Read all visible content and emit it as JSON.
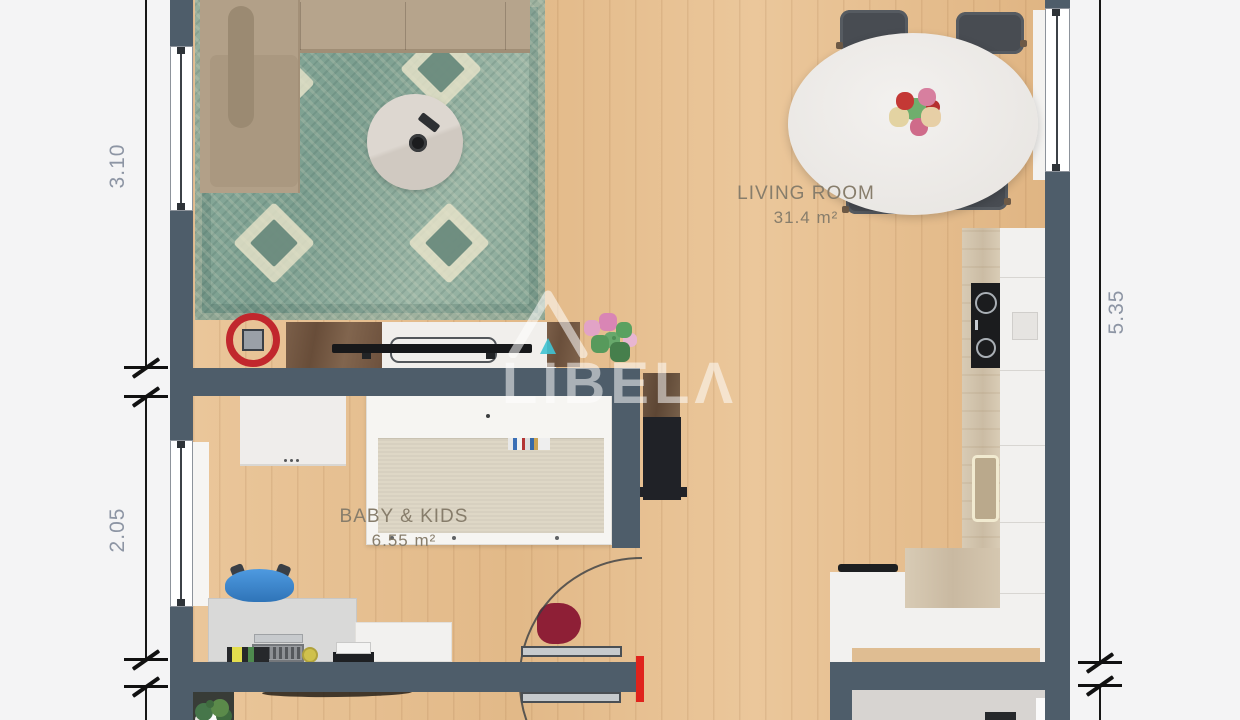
{
  "watermark": {
    "brand": "LIBELΛ",
    "logo_icon": "house-roof-icon",
    "logo_accent_color": "#3fc3d4"
  },
  "rooms": [
    {
      "name": "LIVING ROOM",
      "area": "31.4 m²"
    },
    {
      "name": "BABY & KIDS",
      "area": "6.55 m²"
    }
  ],
  "dimensions": [
    {
      "side": "left-upper",
      "value": "3.10"
    },
    {
      "side": "left-lower",
      "value": "2.05"
    },
    {
      "side": "right",
      "value": "5.35"
    }
  ],
  "palette": {
    "background": "#f4f4f5",
    "wall": "#4e5d6a",
    "floor_wood": "#e8c294",
    "rug_teal": "#8fae9e",
    "marker_red": "#c1272d",
    "door_red": "#e0231c",
    "dimension_text": "#8d95a4",
    "room_label_text": "#877d6b",
    "bathroom_floor": "#d7d4d1"
  },
  "furniture": [
    "corner-sofa",
    "area-rug",
    "coffee-table",
    "tv-lowboard",
    "tv",
    "media-cabinet",
    "dining-table",
    "dining-chair",
    "flower-centerpiece",
    "kitchen-counter",
    "cooktop",
    "kitchen-sink",
    "kitchen-cabinets",
    "tall-black-cabinet",
    "wall-shelf",
    "crib",
    "changing-dresser",
    "kids-desk",
    "desk-chair",
    "laptop",
    "printer",
    "desk-organizer",
    "side-table",
    "red-vase",
    "potted-plant",
    "pink-plant",
    "doormat",
    "door-swing",
    "smoke-detector-marker",
    "window",
    "wardrobe-sill"
  ]
}
